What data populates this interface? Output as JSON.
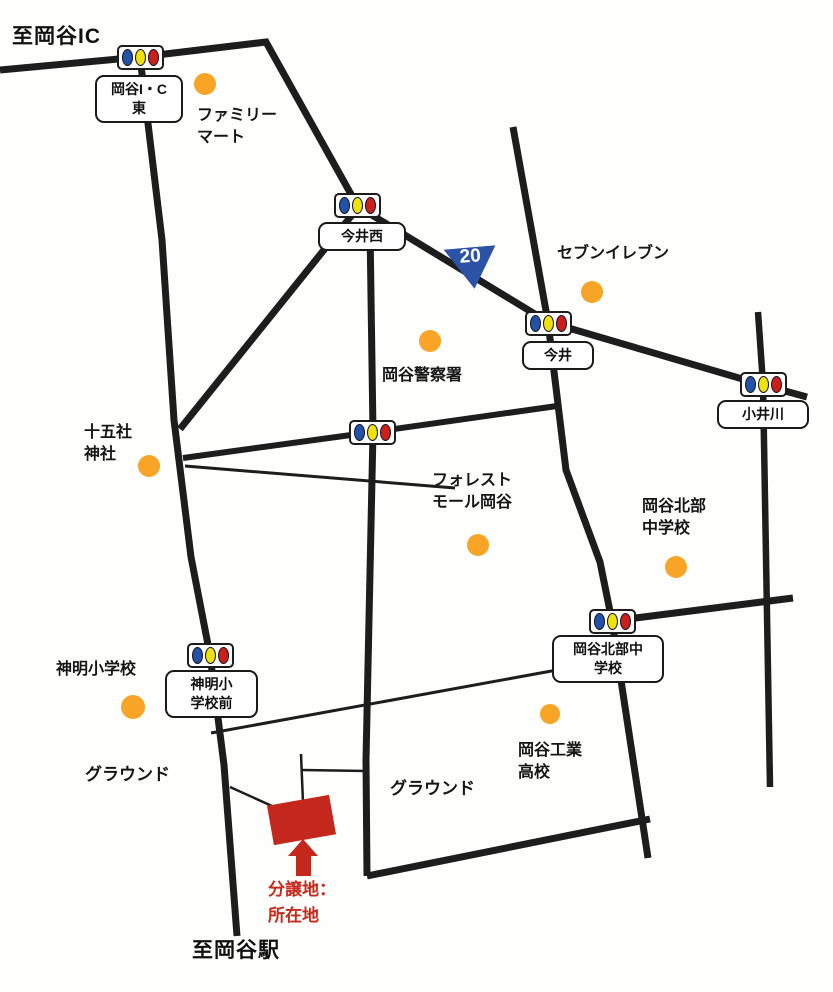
{
  "map": {
    "destinations": {
      "top": "至岡谷IC",
      "bottom": "至岡谷駅"
    },
    "route_badge": {
      "number": "20"
    },
    "signals": [
      {
        "label": "岡谷I・C\n東"
      },
      {
        "label": "今井西"
      },
      {
        "label": "今井"
      },
      {
        "label": "小井川"
      },
      {
        "label": "岡谷北部中\n学校"
      },
      {
        "label": "神明小\n学校前"
      }
    ],
    "landmarks": [
      {
        "label": "ファミリー\nマート"
      },
      {
        "label": "セブンイレブン"
      },
      {
        "label": "岡谷警察署"
      },
      {
        "label": "十五社\n神社"
      },
      {
        "label": "フォレスト\nモール岡谷"
      },
      {
        "label": "岡谷北部\n中学校"
      },
      {
        "label": "神明小学校"
      },
      {
        "label": "岡谷工業\n高校"
      }
    ],
    "grounds": [
      {
        "label": "グラウンド"
      },
      {
        "label": "グラウンド"
      }
    ],
    "site": {
      "caption": "分譲地：\n所在地"
    },
    "colors": {
      "road": "#1d1d1d",
      "landmark_dot": "#f7a427",
      "site_red": "#c4281c",
      "route_blue": "#2b52a4",
      "signal_blue": "#2253a8",
      "signal_yellow": "#efe10a",
      "signal_red": "#cc1f1a"
    }
  }
}
